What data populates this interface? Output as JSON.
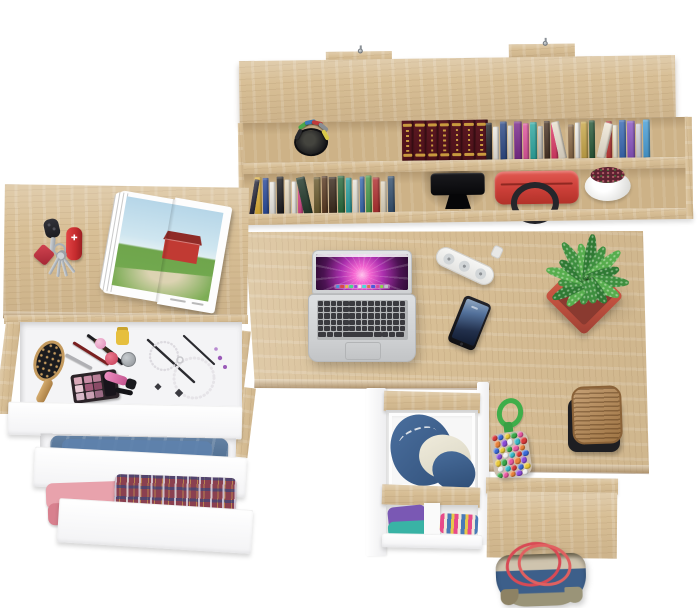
{
  "scene": {
    "description": "Top-down product render of an oak corner desk workstation with wall hutch, open drawers with cosmetics and clothes, laptop and accessories on a white floor",
    "background_color": "#ffffff",
    "wood_color": "#d8bf96",
    "panel_color": "#fbfbfc"
  },
  "hutch": {
    "screw_color": "#9aa0a6",
    "pen_cup": {
      "cup_color": "#17171a",
      "pen_colors": [
        "#4aa84a",
        "#3a7ab8",
        "#c23a3a",
        "#8a8e92",
        "#d8c84a",
        "#2a2a2e"
      ]
    },
    "encyclopedia": {
      "volumes": 7,
      "spine_color": "#5a1822",
      "accent_color": "#c89a3e"
    },
    "top_books": [
      [
        6,
        37,
        "#23232a",
        0
      ],
      [
        6,
        33,
        "#ece9e2",
        0
      ],
      [
        7,
        38,
        "#2e4a86",
        0
      ],
      [
        5,
        34,
        "#d8d5ce",
        0
      ],
      [
        8,
        38,
        "#7a2a8c",
        0
      ],
      [
        6,
        36,
        "#e0559e",
        0
      ],
      [
        7,
        37,
        "#2fa9a2",
        0
      ],
      [
        5,
        33,
        "#c8c5be",
        0
      ],
      [
        6,
        38,
        "#4a3526",
        0
      ],
      [
        7,
        36,
        "#de3a68",
        0
      ],
      [
        8,
        38,
        "#e9e0cf",
        -12
      ],
      [
        6,
        34,
        "#8a6a48",
        0
      ],
      [
        5,
        36,
        "#f2f0ea",
        0
      ],
      [
        7,
        37,
        "#c9a84a",
        0
      ],
      [
        6,
        38,
        "#2a5a3a",
        0
      ],
      [
        9,
        36,
        "#efe7d6",
        14
      ],
      [
        6,
        37,
        "#c03a3a",
        0
      ],
      [
        5,
        33,
        "#f0ead8",
        0
      ],
      [
        7,
        38,
        "#3a6ab4",
        0
      ],
      [
        8,
        37,
        "#8a55c2",
        0
      ],
      [
        6,
        34,
        "#d4d4dc",
        0
      ],
      [
        7,
        38,
        "#4aa0d8",
        0
      ]
    ],
    "lower_books": [
      [
        5,
        36,
        "#2a2a3c",
        10
      ],
      [
        7,
        38,
        "#e0b23a",
        0
      ],
      [
        6,
        37,
        "#2a4a9a",
        0
      ],
      [
        6,
        33,
        "#eceae4",
        0
      ],
      [
        7,
        38,
        "#1c1c20",
        0
      ],
      [
        6,
        35,
        "#e8dcc4",
        0
      ],
      [
        5,
        33,
        "#f4f2ec",
        0
      ],
      [
        5,
        36,
        "#d84a8a",
        0
      ],
      [
        9,
        38,
        "#22382a",
        -12
      ],
      [
        7,
        37,
        "#6a5a2e",
        0
      ],
      [
        6,
        38,
        "#5a3a22",
        0
      ],
      [
        8,
        37,
        "#3a2a1c",
        0
      ],
      [
        7,
        38,
        "#2a6a3c",
        0
      ],
      [
        6,
        36,
        "#2aa0a0",
        0
      ],
      [
        6,
        34,
        "#e8e4da",
        0
      ],
      [
        5,
        37,
        "#3a6ab0",
        0
      ],
      [
        6,
        38,
        "#4a9a4a",
        0
      ],
      [
        7,
        36,
        "#b03030",
        0
      ],
      [
        6,
        32,
        "#e2d8c2",
        0
      ],
      [
        7,
        37,
        "#35506e",
        0
      ]
    ],
    "camera": {
      "body_color": "#0e0e10"
    },
    "handbag": {
      "body_color": "#d6453f",
      "handle_color": "#26262b"
    },
    "round_pot": {
      "pot_color": "#f4f4f2",
      "plant_color": "#5c2230"
    }
  },
  "left_desk": {
    "magazine": {
      "sky": "#b9d8e8",
      "grass": "#6fa54c",
      "barn": "#c13a33",
      "roof": "#8f2b27",
      "path": "#dcd3b2"
    },
    "car_key": {
      "color": "#26262a"
    },
    "pocket_knife": {
      "color": "#c52b2e",
      "emblem": "✚"
    },
    "keychain": {
      "fob_color": "#c13440",
      "key_color": "#b4b8bc",
      "key_angles": [
        -38,
        -16,
        6,
        28
      ]
    }
  },
  "vanity_drawer": {
    "hairbrush": {
      "wood": "#c49a5e",
      "bristle": "#1b1b1e"
    },
    "palette_shades": [
      "#d9a8b8",
      "#c98da6",
      "#b97f98",
      "#e8c9d4",
      "#a05a78",
      "#8a4a66",
      "#d8b8c8",
      "#caa0b4",
      "#9a6a84"
    ],
    "polish_yellow": "#e6bf3e",
    "polish_pink": "#e89ac0",
    "polish_red": "#d84a66",
    "jar_silver": "#a8acb0",
    "lipstick_body": "#e87ab8",
    "lipstick_cap": "#1a1a1e"
  },
  "clothes": {
    "jeans": "#41658e",
    "jeans_fold": "#5e82ad",
    "pink_top": "#e8a2ac",
    "pink_bottom": "#d8808e",
    "plaid_base": "#8a4050",
    "purple": "#7a58b4",
    "teal": "#39b3a5",
    "striped_colors": [
      "#e84a8a",
      "#f0e8d8",
      "#4a7ab8",
      "#e8c84a"
    ]
  },
  "laptop": {
    "body_color": "#d8dadc",
    "key_color": "#3a3a3f",
    "keyboard": {
      "rows": 5,
      "cols": 14,
      "bottom_row": [
        8,
        6,
        8,
        30,
        8,
        6,
        6,
        8
      ]
    },
    "dock_colors": [
      "#4a90d9",
      "#d94a4a",
      "#e8b84a",
      "#4ad98a",
      "#9a4ad9",
      "#e8e8e8",
      "#4ad9d9",
      "#d97a4a",
      "#4a5ad9",
      "#d94a9a",
      "#8ad94a",
      "#c0c0c8"
    ]
  },
  "power_strip": {
    "body_color": "#f0f0ee",
    "sockets": 3
  },
  "phone": {
    "body_color": "#141418",
    "screen_top": "#93a9c2",
    "screen_bottom": "#111b30"
  },
  "plant": {
    "pot_color": "#c2513f",
    "leaf_colors": [
      "#3e8f3f",
      "#57ad4e",
      "#2f7a34"
    ],
    "leaves": [
      [
        -168,
        25
      ],
      [
        -142,
        33
      ],
      [
        -118,
        40
      ],
      [
        -96,
        30
      ],
      [
        -76,
        43
      ],
      [
        -56,
        34
      ],
      [
        -34,
        45
      ],
      [
        -12,
        37
      ],
      [
        6,
        46
      ],
      [
        26,
        37
      ],
      [
        48,
        43
      ],
      [
        70,
        33
      ],
      [
        94,
        41
      ],
      [
        118,
        35
      ],
      [
        142,
        29
      ],
      [
        166,
        24
      ]
    ]
  },
  "stool": {
    "top_color": "#b5854e",
    "base_color": "#1e1e22"
  },
  "pompom": {
    "rope_color": "#3fae4a",
    "bead_colors": [
      "#d83a3a",
      "#3a6ad8",
      "#e8c83a",
      "#3aa84a",
      "#e858a0",
      "#e8813a",
      "#8a4ad8",
      "#f0f0f0",
      "#38b8c8"
    ]
  },
  "storage_drawer": {
    "denim": "#3f6492",
    "denim_dark": "#2c4a72",
    "cloth": "#e8e4d4"
  },
  "tote_bag": {
    "denim": "#3d5f8a",
    "trim": "#cfc4ae",
    "khaki": "#9a9478",
    "handle": "#d84a55"
  }
}
